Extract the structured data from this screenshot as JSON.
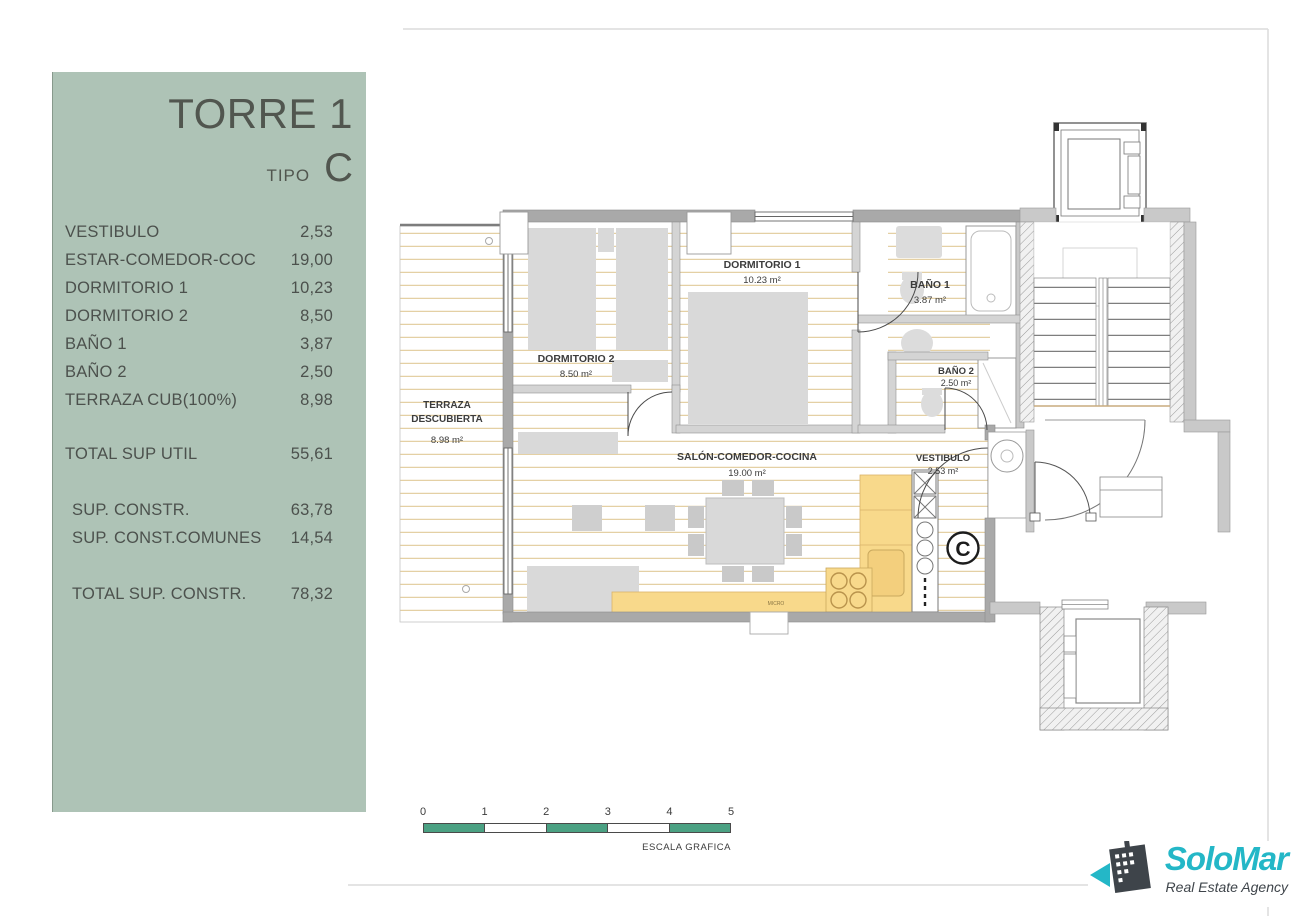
{
  "panel": {
    "title": "TORRE 1",
    "tipo_label": "TIPO",
    "tipo_value": "C",
    "rows": [
      {
        "label": "VESTIBULO",
        "value": "2,53"
      },
      {
        "label": "ESTAR-COMEDOR-COC",
        "value": "19,00"
      },
      {
        "label": "DORMITORIO 1",
        "value": "10,23"
      },
      {
        "label": "DORMITORIO 2",
        "value": "8,50"
      },
      {
        "label": "BAÑO 1",
        "value": "3,87"
      },
      {
        "label": "BAÑO 2",
        "value": "2,50"
      },
      {
        "label": "TERRAZA CUB(100%)",
        "value": "8,98"
      }
    ],
    "total_util": {
      "label": "TOTAL SUP UTIL",
      "value": "55,61"
    },
    "constr_rows": [
      {
        "label": "SUP. CONSTR.",
        "value": "63,78"
      },
      {
        "label": "SUP. CONST.COMUNES",
        "value": "14,54"
      }
    ],
    "total_constr": {
      "label": "TOTAL SUP. CONSTR.",
      "value": "78,32"
    }
  },
  "plan": {
    "rooms": {
      "terraza": {
        "line1": "TERRAZA",
        "line2": "DESCUBIERTA",
        "area": "8.98 m²"
      },
      "dormitorio2": {
        "name": "DORMITORIO 2",
        "area": "8.50 m²"
      },
      "dormitorio1": {
        "name": "DORMITORIO 1",
        "area": "10.23 m²"
      },
      "bano1": {
        "name": "BAÑO 1",
        "area": "3.87 m²"
      },
      "bano2": {
        "name": "BAÑO 2",
        "area": "2.50 m²"
      },
      "salon": {
        "name": "SALÓN-COMEDOR-COCINA",
        "area": "19.00 m²"
      },
      "vestibulo": {
        "name": "VESTIBULO",
        "area": "2.53 m²"
      }
    },
    "unit_marker": "C",
    "micro_label": "MICRO"
  },
  "scale_bar": {
    "ticks": [
      "0",
      "1",
      "2",
      "3",
      "4",
      "5"
    ],
    "caption": "ESCALA GRAFICA"
  },
  "logo": {
    "name": "SoloMar",
    "tagline": "Real Estate Agency"
  },
  "colors": {
    "panel-green": "#aec3b6",
    "panel-text": "#4c514d",
    "scale-green": "#4ba183",
    "logo-teal": "#24b7c7",
    "logo-dark": "#3e444a",
    "kitchen-yellow": "#f8d98b"
  }
}
